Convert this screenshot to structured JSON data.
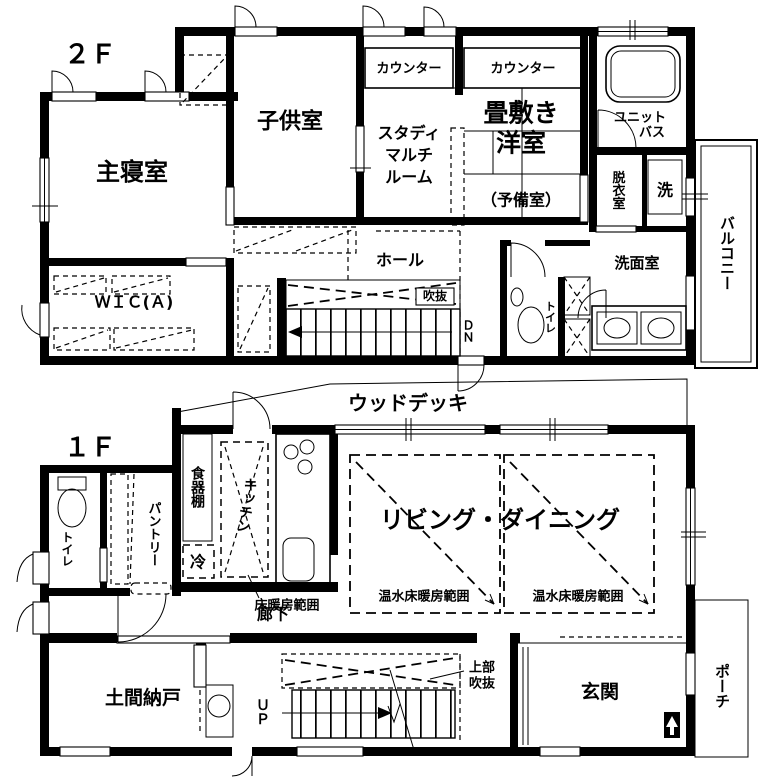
{
  "colors": {
    "ink": "#000000",
    "paper": "#ffffff"
  },
  "f2": {
    "floor_label": "２Ｆ",
    "master_bedroom": "主寝室",
    "kids_room": "子供室",
    "counter_study": "カウンター",
    "counter_tatami": "カウンター",
    "study_room_lines": [
      "スタディ",
      "マルチ",
      "ルーム"
    ],
    "tatami_room_line1": "畳敷き",
    "tatami_room_line2": "洋室",
    "tatami_room_line3": "（予備室）",
    "unit_bath_line1": "ユニット",
    "unit_bath_line2": "バス",
    "dressing_room": "脱衣室",
    "washer": "洗",
    "washroom": "洗面室",
    "balcony": "バルコニー",
    "wic": "ＷＩＣ(Ａ)",
    "hall": "ホール",
    "void_label": "吹抜",
    "down": "ＤＮ",
    "toilet": "トイレ"
  },
  "f1": {
    "floor_label": "１Ｆ",
    "wood_deck": "ウッドデッキ",
    "cupboard": "食器棚",
    "kitchen": "キッチン",
    "fridge": "冷",
    "pantry": "パントリー",
    "toilet": "トイレ",
    "corridor": "廊下",
    "floor_heating": "床暖房範囲",
    "living_dining": "リビング・ダイニング",
    "hot_water_heating_left": "温水床暖房範囲",
    "hot_water_heating_right": "温水床暖房範囲",
    "upper_void_line1": "上部",
    "upper_void_line2": "吹抜",
    "up": "ＵＰ",
    "doma_storage": "土間納戸",
    "entrance": "玄関",
    "porch": "ポーチ"
  }
}
